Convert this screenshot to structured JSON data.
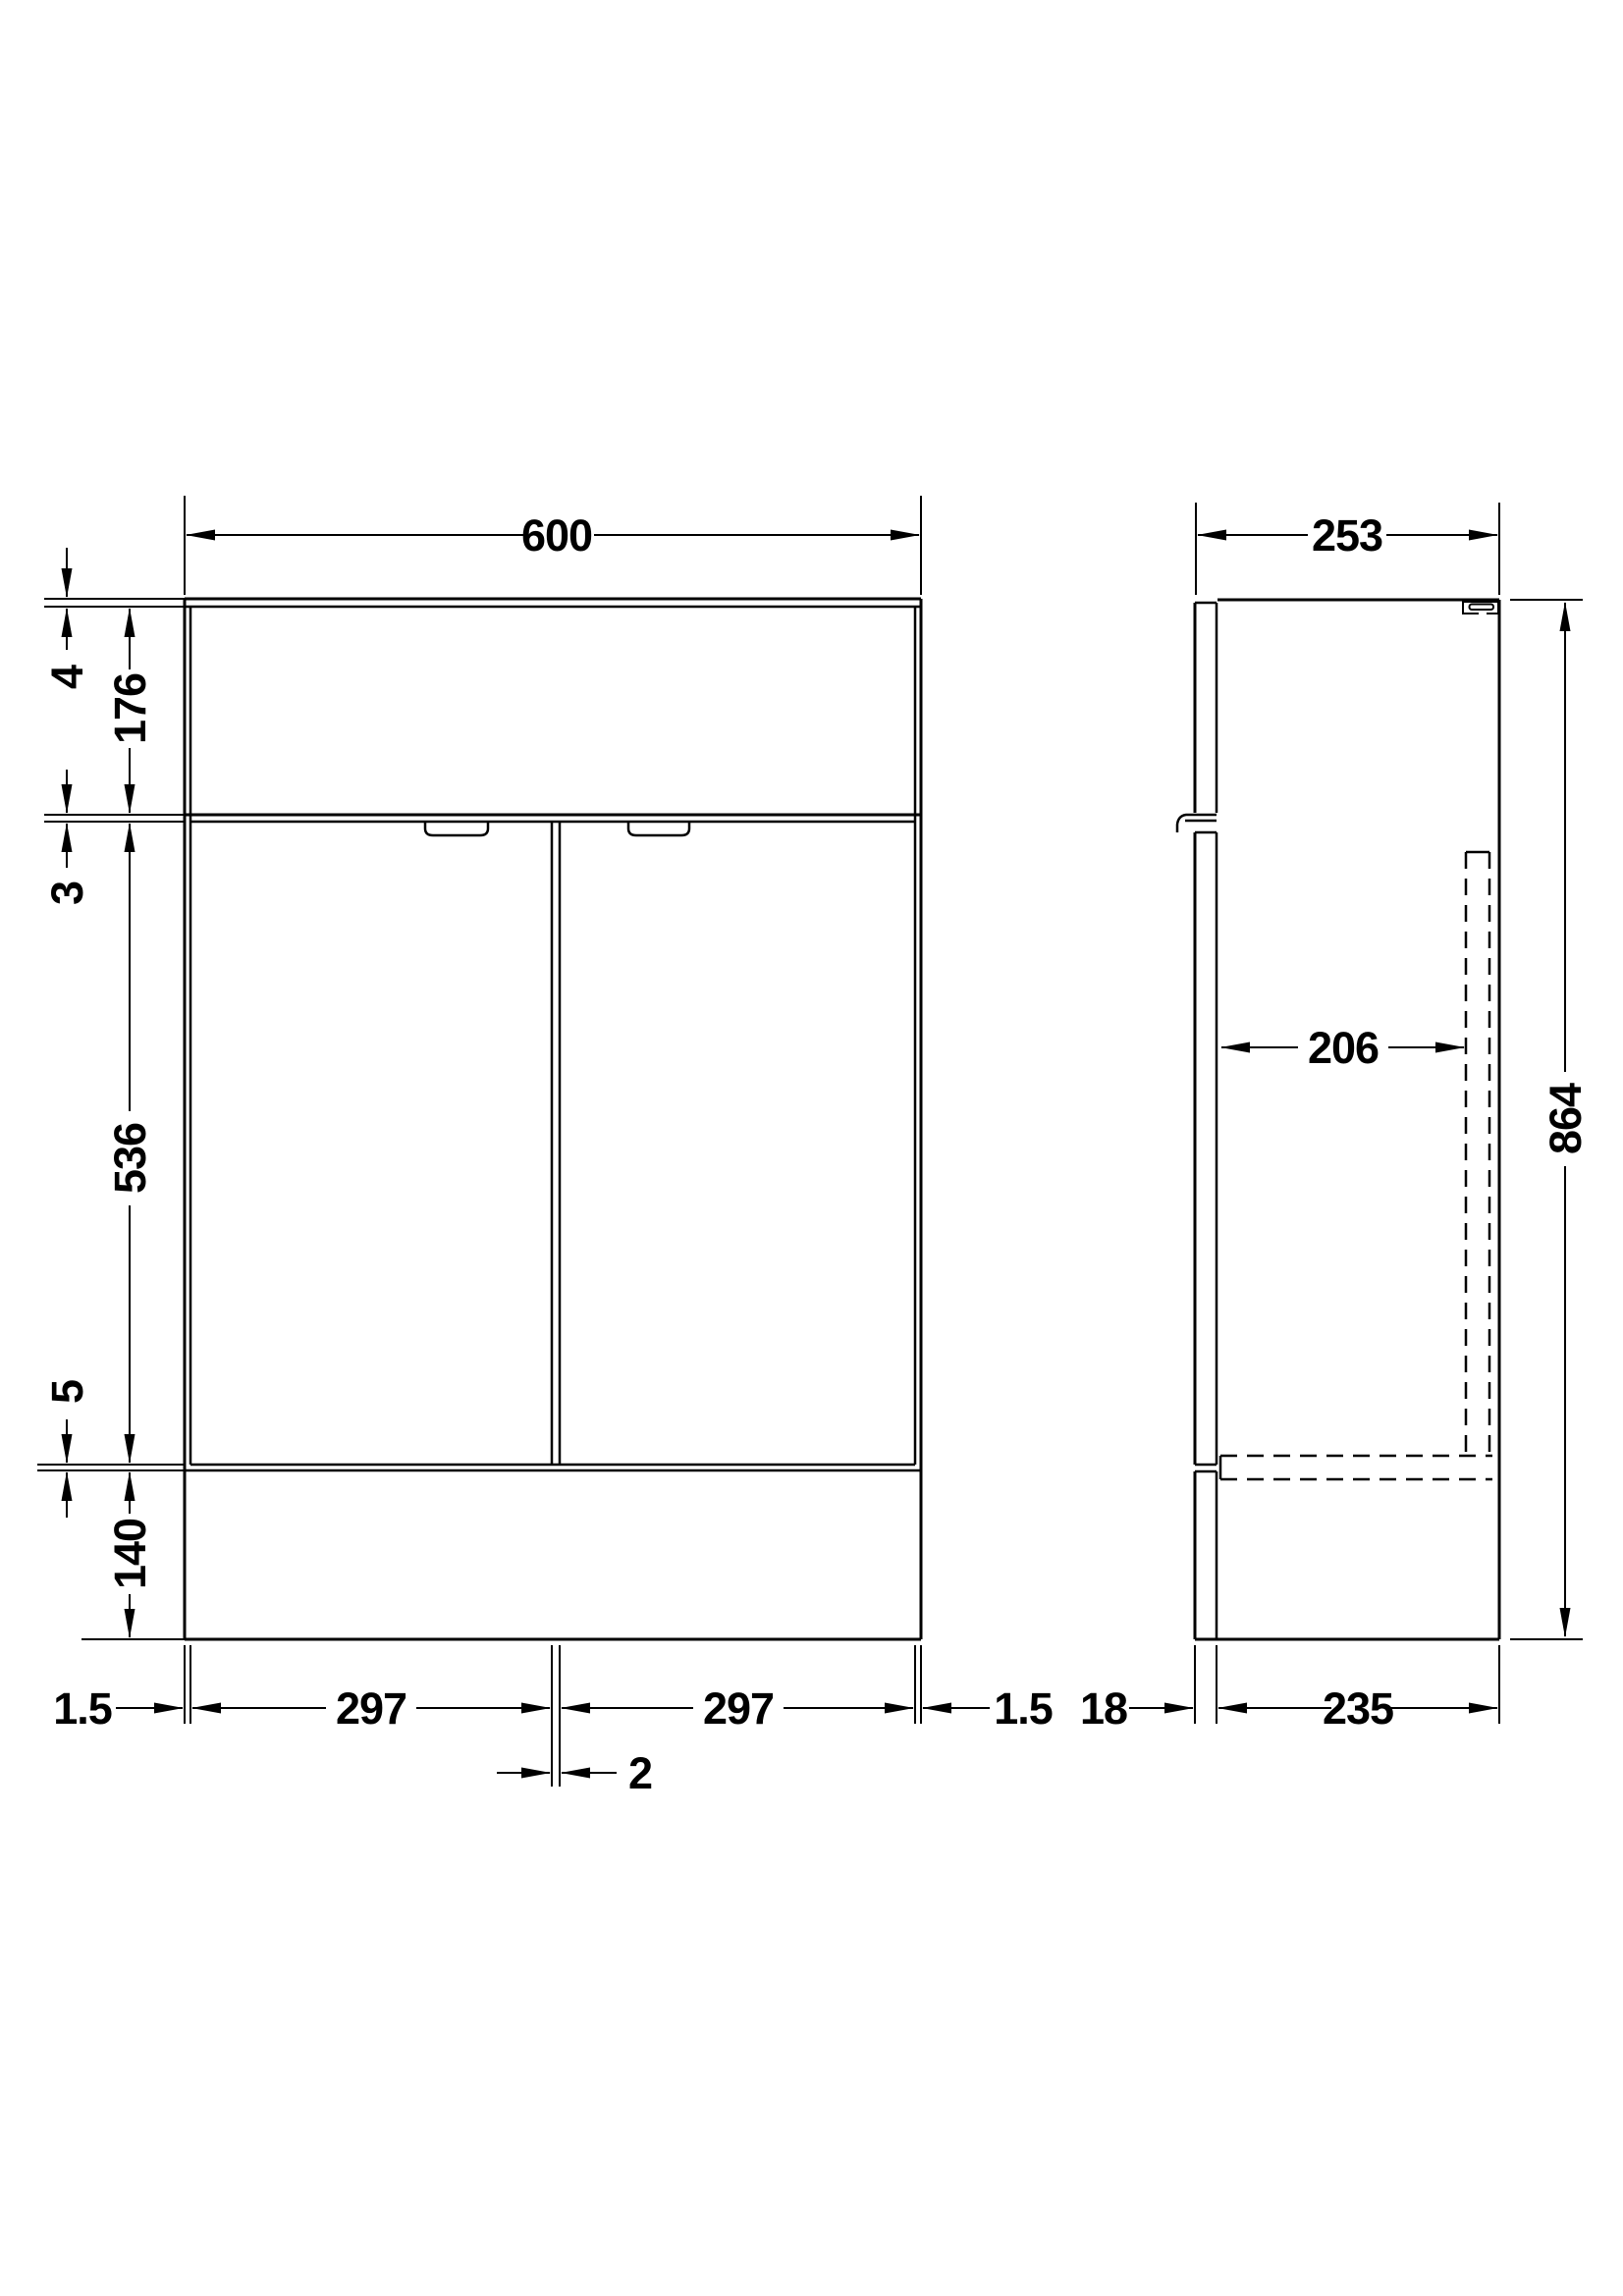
{
  "drawing": {
    "type": "bathroom vanity unit dimension drawing",
    "views": {
      "front": "front elevation",
      "side": "side elevation"
    },
    "dims": {
      "front": {
        "overall_width": "600",
        "counter_thickness": "4",
        "fascia_height": "176",
        "fascia_door_gap": "3",
        "door_height": "536",
        "door_plinth_gap": "5",
        "plinth_height": "140",
        "edge_gap_left": "1.5",
        "left_door_width": "297",
        "right_door_width": "297",
        "edge_gap_right": "1.5",
        "door_gap": "2"
      },
      "side": {
        "overall_depth": "253",
        "internal_depth": "206",
        "overall_height": "864",
        "door_thickness": "18",
        "carcass_depth": "235"
      }
    },
    "line_color": "#000000",
    "background_color": "#ffffff"
  }
}
